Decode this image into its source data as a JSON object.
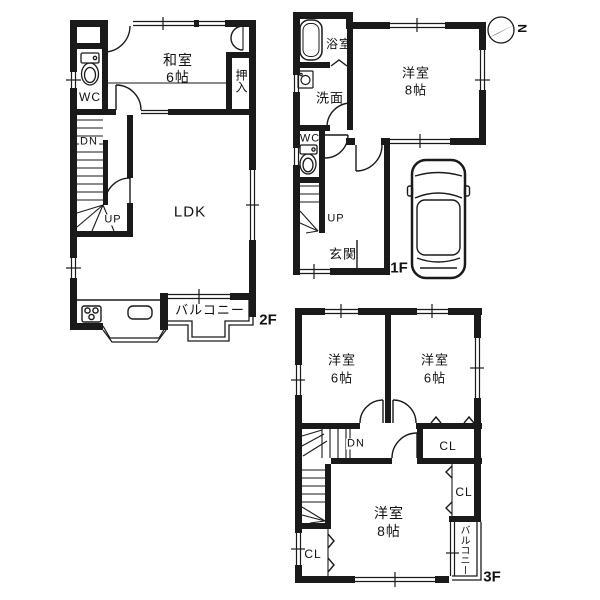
{
  "floors": {
    "second": {
      "label": "2F",
      "washitsu": "和室",
      "washitsu_size": "6帖",
      "oshiire": "押入",
      "wc": "WC",
      "ldk": "LDK",
      "balcony": "バルコニー",
      "up": "UP",
      "dn": "DN"
    },
    "first": {
      "label": "1F",
      "bath": "浴室",
      "washroom": "洗面",
      "wc": "WC",
      "room": "洋室",
      "room_size": "8帖",
      "genkan": "玄関",
      "up": "UP"
    },
    "third": {
      "label": "3F",
      "room_small": "洋室",
      "room_small_size": "6帖",
      "room_large": "洋室",
      "room_large_size": "8帖",
      "closet": "CL",
      "balcony": "バルコニー",
      "dn": "DN"
    }
  },
  "compass": {
    "north": "N"
  },
  "colors": {
    "line": "#1a1a1a",
    "background": "#ffffff"
  }
}
